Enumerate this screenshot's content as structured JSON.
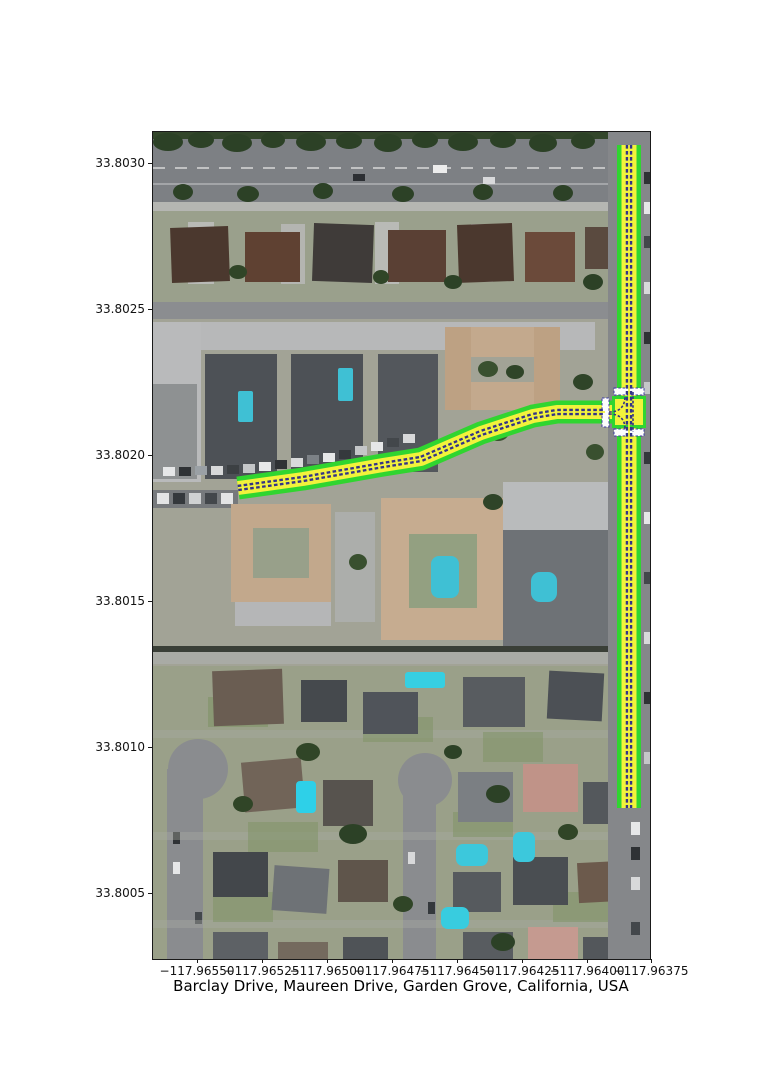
{
  "title": "Barclay Drive, Maureen Drive, Garden Grove, California, USA",
  "axes": {
    "x_ticks": [
      "−117.96550",
      "−117.96525",
      "−117.96500",
      "−117.96475",
      "−117.96450",
      "−117.96425",
      "−117.96400",
      "−117.96375"
    ],
    "y_ticks": [
      "33.8030",
      "33.8025",
      "33.8020",
      "33.8015",
      "33.8010",
      "33.8005"
    ]
  },
  "map": {
    "place": "Garden Grove, California, USA",
    "streets": [
      "Barclay Drive",
      "Maureen Drive"
    ],
    "imagery": "aerial-photo",
    "route_style": {
      "outline_color": "#30d530",
      "lane_fill_color": "#f2f23c",
      "centerline_color": "#333387",
      "stop_bar_color": "#fdfdfd",
      "stop_bar_edge_color": "#3a3aa0"
    },
    "route_extent": {
      "vertical_street_lon": "-117.96384",
      "vertical_street_lat_span": "33.80068 to 33.80295",
      "horizontal_street_lat": "33.80195",
      "horizontal_street_lon_span": "-117.96535 to -117.96384"
    }
  }
}
